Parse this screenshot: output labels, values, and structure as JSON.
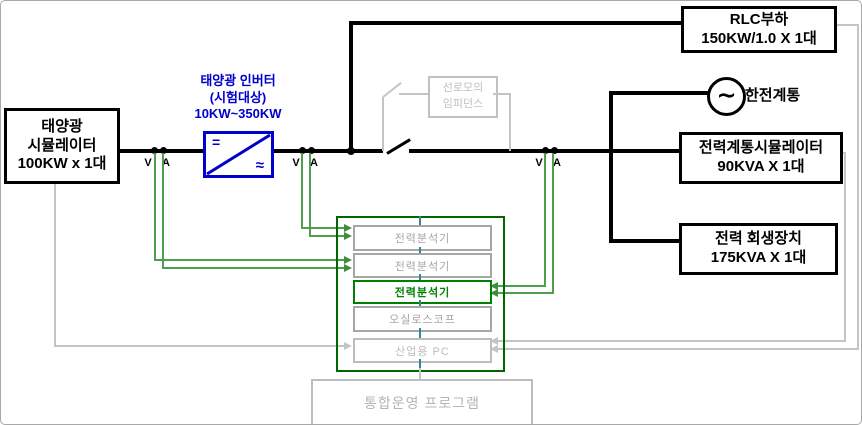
{
  "colors": {
    "power_line_black": "#000000",
    "inverter_blue": "#0000cc",
    "measurement_green": "#4d9e4d",
    "frame_green": "#006600",
    "active_analyzer_green": "#008000",
    "connector_teal": "#31859c",
    "inactive_gray": "#c0c0c0"
  },
  "pv_simulator": {
    "line1": "태양광",
    "line2": "시뮬레이터",
    "line3": "100KW x 1대"
  },
  "inverter": {
    "title": "태양광 인버터",
    "subtitle": "(시험대상)",
    "range": "10KW~350KW",
    "dc_symbol": "=",
    "ac_symbol": "≈"
  },
  "rlc_load": {
    "line1": "RLC부하",
    "line2": "150KW/1.0 X 1대"
  },
  "kepco_grid": {
    "label": "한전계통",
    "symbol": "∼"
  },
  "grid_simulator": {
    "line1": "전력계통시뮬레이터",
    "line2": "90KVA X 1대"
  },
  "regenerator": {
    "line1": "전력 회생장치",
    "line2": "175KVA X 1대"
  },
  "line_impedance": {
    "line1": "선로모의",
    "line2": "임피던스"
  },
  "instruments": {
    "analyzer1": "전력분석기",
    "analyzer2": "전력분석기",
    "analyzer3": "전력분석기",
    "oscilloscope": "오실로스코프",
    "pc": "산업용 PC"
  },
  "program": {
    "label": "통합운영 프로그램"
  },
  "meter": {
    "voltage": "V",
    "current": "A"
  }
}
